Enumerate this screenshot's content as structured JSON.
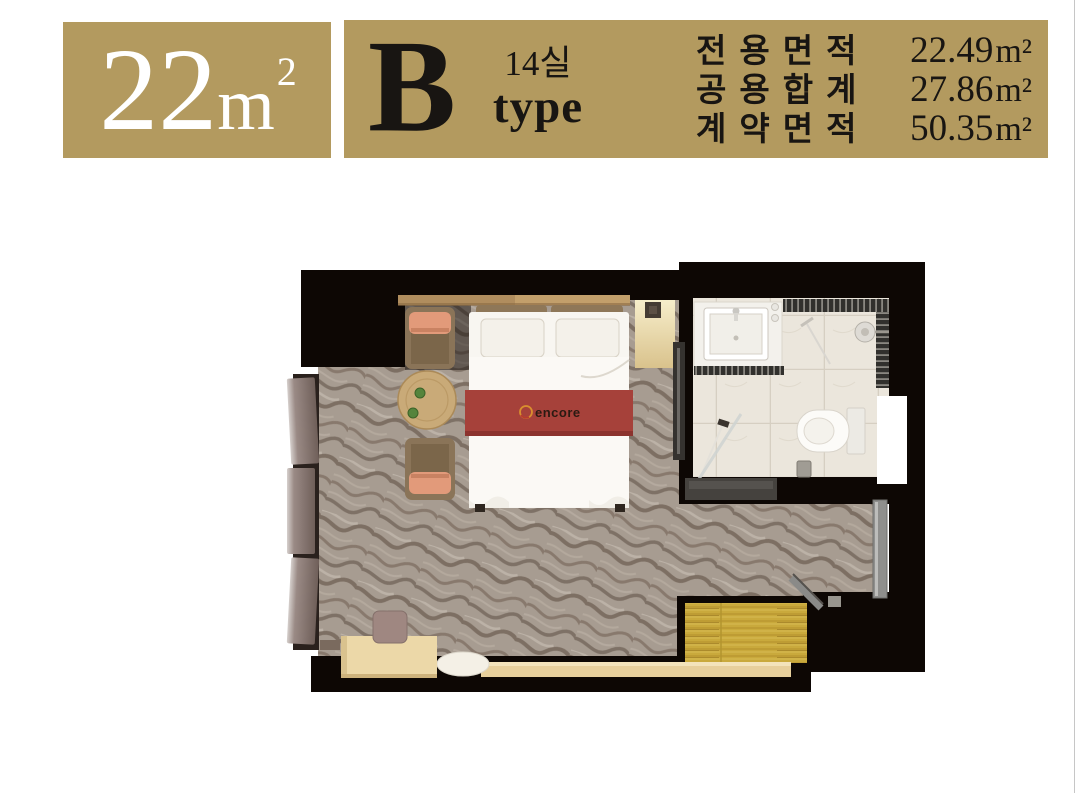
{
  "page": {
    "background": "#ffffff",
    "accent_gold": "#b39a5f",
    "wall_black": "#0d0704"
  },
  "area_badge": {
    "number": "22",
    "unit": "m",
    "sup": "2"
  },
  "type_badge": {
    "letter": "B",
    "rooms": "14실",
    "word": "type"
  },
  "area_table": {
    "rows": [
      {
        "label": "전용면적",
        "value": "22.49",
        "unit": "m²"
      },
      {
        "label": "공용합계",
        "value": "27.86",
        "unit": "m²"
      },
      {
        "label": "계약면적",
        "value": "50.35",
        "unit": "m²"
      }
    ]
  },
  "floorplan": {
    "bed_brand": "encore",
    "colors": {
      "carpet": "#a79c91",
      "carpet_strand": "#6f6054",
      "runner_red": "#a6413a",
      "bathroom_tile": "#ebe6dc",
      "entry_mat": "#c9a93c",
      "wood_light": "#ecd8a8",
      "cushion_salmon": "#e29a7a",
      "chair_frame": "#8a7458",
      "window_frame": "#857471"
    }
  }
}
